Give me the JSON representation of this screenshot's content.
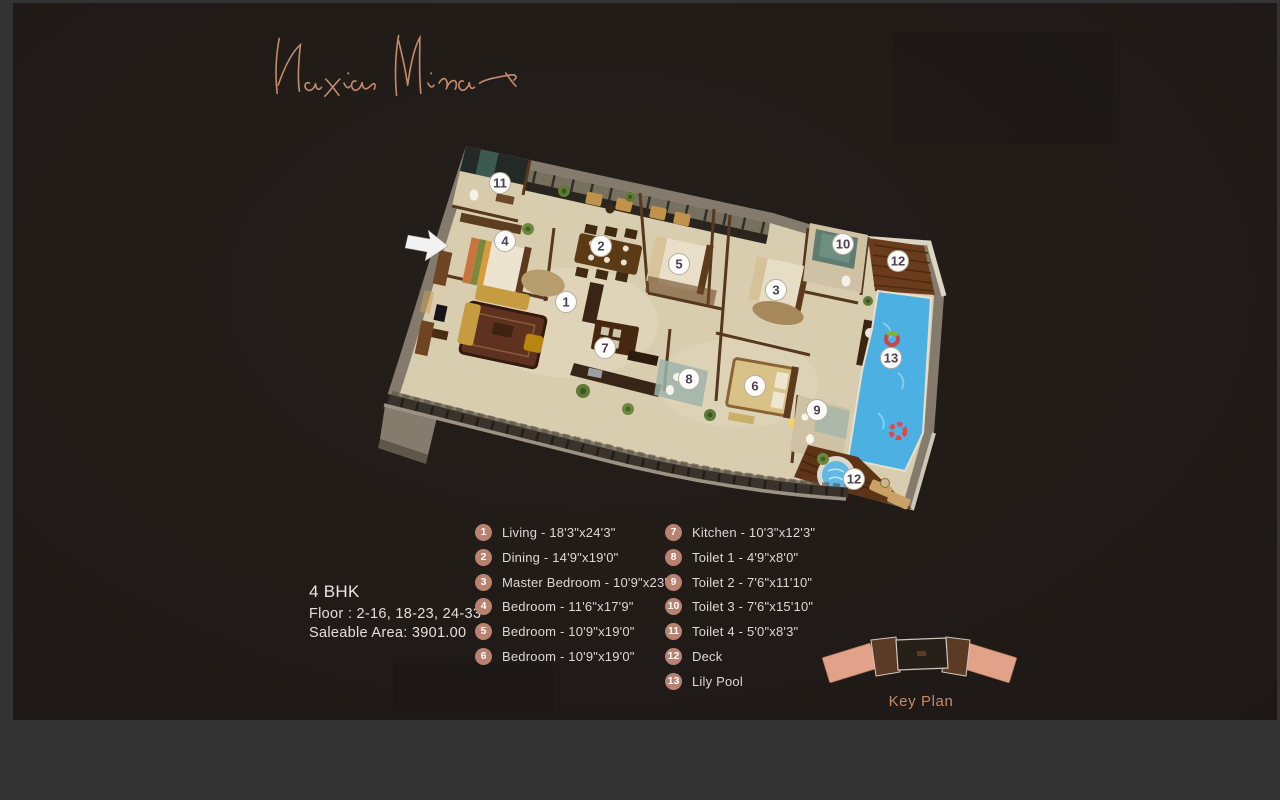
{
  "colors": {
    "backdrop": "#333333",
    "page_bg": "#211b18",
    "accent_salmon": "#b98170",
    "keyplan_wing": "#e2a289",
    "keyplan_block": "#5c3b26",
    "pool_blue": "#4db0e2",
    "floor_beige": "#d9cdb0"
  },
  "brand": {
    "name": "Naxia Minar"
  },
  "unit_info": {
    "type": "4 BHK",
    "floor": "Floor : 2-16, 18-23, 24-33",
    "saleable_area": "Saleable Area: 3901.00"
  },
  "legend": {
    "left": [
      {
        "num": "1",
        "label": "Living - 18'3\"x24'3\""
      },
      {
        "num": "2",
        "label": "Dining - 14'9\"x19'0\""
      },
      {
        "num": "3",
        "label": "Master Bedroom - 10'9\"x23'0\""
      },
      {
        "num": "4",
        "label": "Bedroom - 11'6\"x17'9\""
      },
      {
        "num": "5",
        "label": "Bedroom - 10'9\"x19'0\""
      },
      {
        "num": "6",
        "label": "Bedroom - 10'9\"x19'0\""
      }
    ],
    "right": [
      {
        "num": "7",
        "label": "Kitchen - 10'3\"x12'3\""
      },
      {
        "num": "8",
        "label": "Toilet 1 - 4'9\"x8'0\""
      },
      {
        "num": "9",
        "label": "Toilet 2 - 7'6\"x11'10\""
      },
      {
        "num": "10",
        "label": "Toilet 3 - 7'6\"x15'10\""
      },
      {
        "num": "11",
        "label": "Toilet 4 - 5'0\"x8'3\""
      },
      {
        "num": "12",
        "label": "Deck"
      },
      {
        "num": "13",
        "label": "Lily Pool"
      }
    ]
  },
  "key_plan": {
    "label": "Key Plan"
  },
  "floor_plan": {
    "markers": [
      {
        "num": "1",
        "x": 188,
        "y": 169
      },
      {
        "num": "2",
        "x": 223,
        "y": 113
      },
      {
        "num": "3",
        "x": 398,
        "y": 157
      },
      {
        "num": "4",
        "x": 127,
        "y": 108
      },
      {
        "num": "5",
        "x": 301,
        "y": 131
      },
      {
        "num": "6",
        "x": 377,
        "y": 253
      },
      {
        "num": "7",
        "x": 227,
        "y": 215
      },
      {
        "num": "8",
        "x": 311,
        "y": 246
      },
      {
        "num": "9",
        "x": 439,
        "y": 277
      },
      {
        "num": "10",
        "x": 465,
        "y": 111
      },
      {
        "num": "11",
        "x": 122,
        "y": 50
      },
      {
        "num": "12",
        "x": 520,
        "y": 128
      },
      {
        "num": "12",
        "x": 476,
        "y": 346
      },
      {
        "num": "13",
        "x": 513,
        "y": 225
      }
    ]
  }
}
